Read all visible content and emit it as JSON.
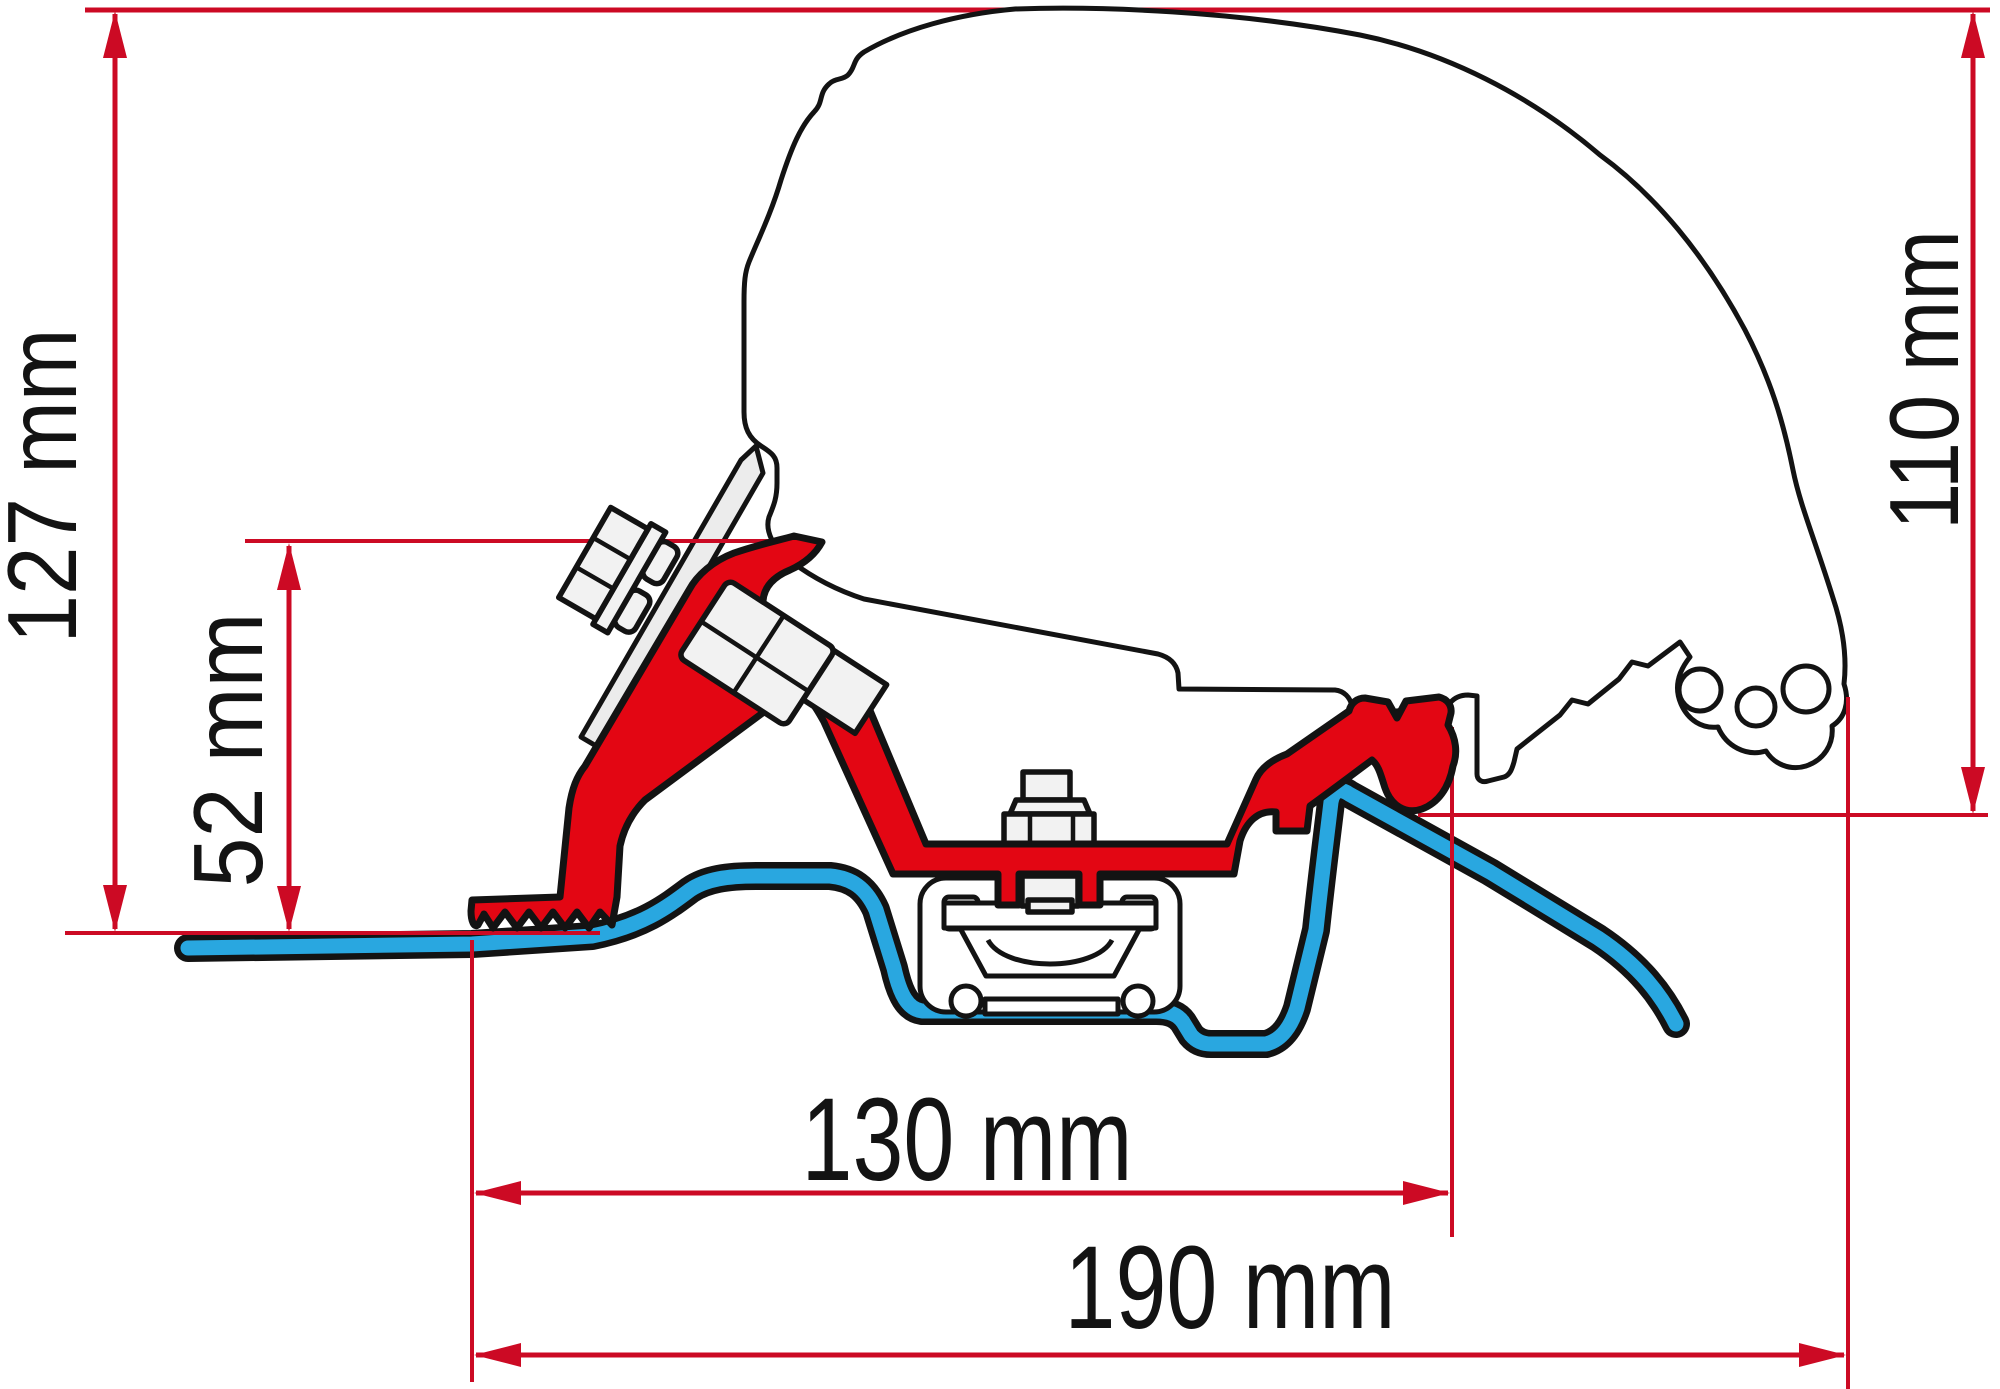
{
  "diagram": {
    "type": "technical-dimension-drawing",
    "subject": "Awning roof adapter bracket cross-section mounted on a van roof profile",
    "units": "mm",
    "dimensions": [
      {
        "id": "overall-height",
        "label": "127 mm",
        "value": 127,
        "orientation": "vertical",
        "position": "left"
      },
      {
        "id": "bracket-height",
        "label": "52 mm",
        "value": 52,
        "orientation": "vertical",
        "position": "left-inner"
      },
      {
        "id": "rail-height",
        "label": "110 mm",
        "value": 110,
        "orientation": "vertical",
        "position": "right"
      },
      {
        "id": "bracket-span",
        "label": "130 mm",
        "value": 130,
        "orientation": "horizontal",
        "position": "bottom-inner"
      },
      {
        "id": "overall-span",
        "label": "190 mm",
        "value": 190,
        "orientation": "horizontal",
        "position": "bottom"
      }
    ],
    "parts": [
      {
        "name": "van-body-profile",
        "color_key": "outline_black"
      },
      {
        "name": "adapter-bracket",
        "color_key": "bracket_red"
      },
      {
        "name": "roof-sheet",
        "color_key": "roof_blue"
      },
      {
        "name": "mounting-plate",
        "color_key": "plate_gray"
      },
      {
        "name": "fastening-bolts",
        "color_key": "plate_gray"
      }
    ],
    "colors": {
      "dimension_red": "#cc0a24",
      "bracket_red": "#e30613",
      "roof_blue": "#29a7e0",
      "outline_black": "#131313",
      "plate_gray": "#ececec",
      "background": "#ffffff"
    }
  }
}
